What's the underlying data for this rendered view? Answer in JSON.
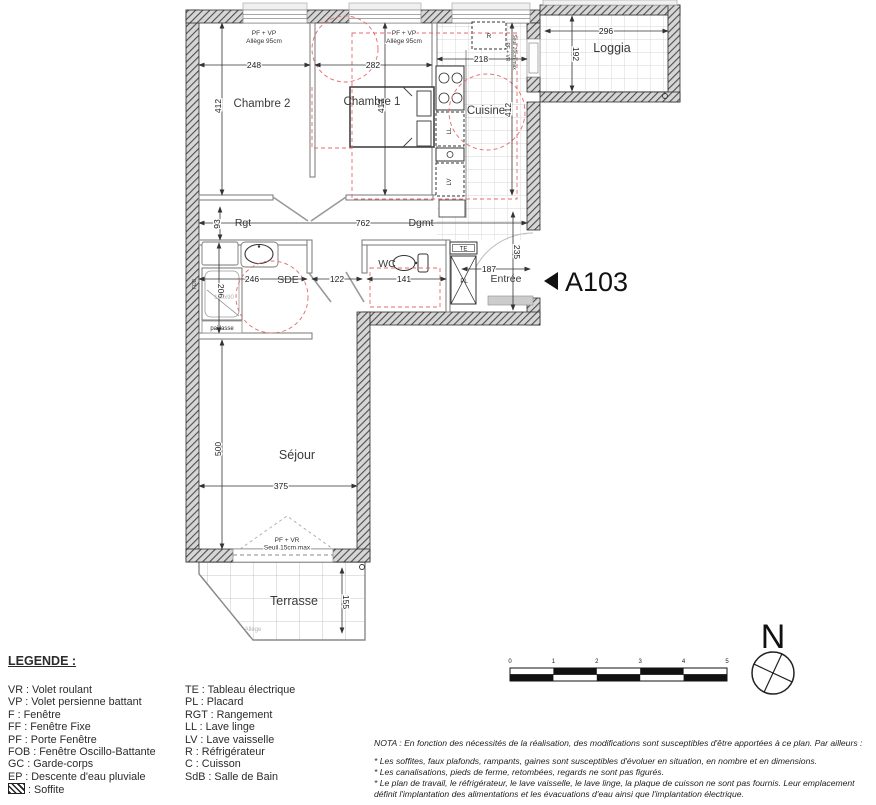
{
  "plan": {
    "unit": "A103",
    "labels": {
      "chambre2": "Chambre 2",
      "chambre1": "Chambre 1",
      "cuisine": "Cuisine",
      "loggia": "Loggia",
      "rgt": "Rgt",
      "dgmt": "Dgmt",
      "sde": "SDE",
      "wc": "WC",
      "entree": "Entrée",
      "sejour": "Séjour",
      "terrasse": "Terrasse"
    },
    "dims": {
      "chambre2_w": "248",
      "chambre1_w": "282",
      "cuisine_w": "218",
      "loggia_w": "296",
      "loggia_h": "192",
      "chambre2_h": "412",
      "chambre1_h": "412",
      "cuisine_h": "412",
      "rgt_h": "93",
      "corridor_w": "762",
      "entree_h": "235",
      "entree_w": "187",
      "sde_w": "246",
      "sde_h": "206",
      "passage_w": "122",
      "wc_w": "141",
      "sejour_w": "375",
      "sejour_h": "500",
      "terrasse_h": "155",
      "shower": "120x90"
    },
    "tags": {
      "te": "TE",
      "pl": "PL",
      "r": "R",
      "ll": "LL",
      "lv": "LV",
      "fob": "FOB",
      "paillasse": "paillasse"
    },
    "windows": {
      "ch2_1": "PF + VP",
      "ch2_2": "Allège 95cm",
      "ch1_1": "PF + VP",
      "ch1_2": "Allège 95cm",
      "loggia_door_1": "PF + VR",
      "loggia_door_2": "Seuil 20cm max",
      "sejour_1": "PF + VR",
      "sejour_2": "Seuil 15cm max",
      "terrasse_allege": "Allège"
    }
  },
  "legend": {
    "title": "LEGENDE :",
    "col1": [
      "VR : Volet roulant",
      "VP : Volet persienne battant",
      "F : Fenêtre",
      "FF : Fenêtre Fixe",
      "PF : Porte Fenêtre",
      "FOB : Fenêtre Oscillo-Battante",
      "GC : Garde-corps",
      "EP : Descente d'eau pluviale"
    ],
    "soffite": ": Soffite",
    "col2": [
      "TE : Tableau électrique",
      "PL : Placard",
      "RGT : Rangement",
      "LL : Lave linge",
      "LV : Lave vaisselle",
      "R : Réfrigérateur",
      "C : Cuisson",
      "SdB : Salle de Bain"
    ]
  },
  "notes": {
    "nota": "NOTA : En fonction des nécessités de la réalisation, des modifications sont susceptibles d'être apportées à ce plan. Par ailleurs :",
    "b1": "* Les soffites, faux plafonds, rampants, gaines sont susceptibles d'évoluer en situation, en nombre et en dimensions.",
    "b2": "* Les canalisations, pieds de ferme, retombées, regards ne sont pas figurés.",
    "b3": "* Le plan de travail, le réfrigérateur, le lave vaisselle, le lave linge, la plaque de cuisson ne sont pas fournis. Leur emplacement définit l'implantation des alimentations et les évacuations d'eau ainsi que l'implantation électrique."
  },
  "scale": {
    "ticks": [
      "0",
      "1",
      "2",
      "3",
      "4",
      "5"
    ]
  },
  "compass": {
    "north": "N"
  },
  "colors": {
    "red_accessibility": "#e46a6a",
    "wall": "#2e2e2e"
  }
}
